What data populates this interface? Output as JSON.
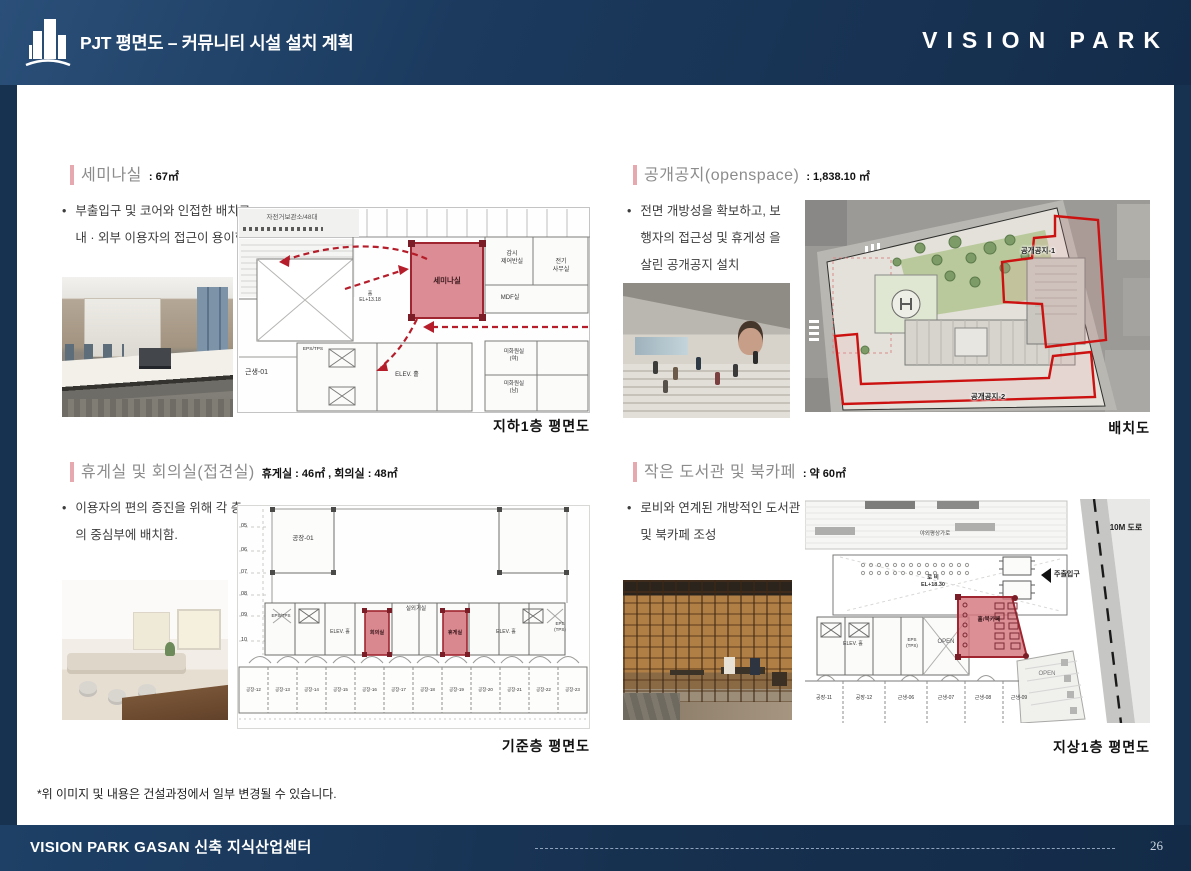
{
  "header": {
    "title": "PJT 평면도 – 커뮤니티 시설 설치 계획",
    "brand": "VISION PARK"
  },
  "sections": {
    "seminar": {
      "title": "세미나실",
      "area": ": 67㎡",
      "bullet": "부출입구 및 코어와 인접한 배치로 내 · 외부 이용자의 접근이 용이함.",
      "caption": "지하1층 평면도",
      "plan": {
        "bike_storage": "자전거보관소/48대",
        "highlight": "세미나실",
        "room_gamsi": "감시\n제어반실",
        "room_jeongi": "전기\n사무실",
        "room_mdf": "MDF실",
        "room_geunsaeng": "근생-01",
        "room_elev": "ELEV. 홀",
        "room_eps": "EPS/TPS",
        "hall_level": "홀\nEL+13.18",
        "room_mihwa_f": "미화원실\n(여)",
        "room_mihwa_m": "미화원실\n(남)"
      }
    },
    "openspace": {
      "title": "공개공지(openspace)",
      "area": ": 1,838.10 ㎡",
      "bullet": "전면 개방성을 확보하고, 보행자의 접근성 및 휴게성 을 살린 공개공지 설치",
      "caption": "배치도",
      "plan": {
        "zone1": "공개공지-1",
        "zone2": "공개공지-2"
      }
    },
    "lounge": {
      "title": "휴게실 및 회의실(접견실)",
      "area": "휴게실 : 46㎡ , 회의실 : 48㎡",
      "bullet": "이용자의 편의 증진을 위해 각 층의 중심부에 배치함.",
      "caption": "기준층 평면도",
      "plan": {
        "room_top": "공장-01",
        "room_eps": "EPS/TPS",
        "room_elev1": "ELEV. 홀",
        "highlight1": "회의실",
        "room_center": "실외기실",
        "highlight2": "휴게실",
        "room_elev2": "ELEV. 홀",
        "room_eps2": "EPS\n(TPS)",
        "row_numbers": [
          "05",
          "06",
          "07",
          "08",
          "09",
          "10"
        ],
        "bottom_rooms": [
          "공장-12",
          "공장-13",
          "공장-14",
          "공장-15",
          "공장-16",
          "공장-17",
          "공장-18",
          "공장-19",
          "공장-20",
          "공장-21",
          "공장-22",
          "공장-23"
        ]
      }
    },
    "library": {
      "title": "작은 도서관 및 북카페",
      "area": ": 약 60㎡",
      "bullet": "로비와 연계된 개방적인 도서관 및 북카페 조성",
      "caption": "지상1층 평면도",
      "plan": {
        "promenade": "야외평상가로",
        "lobby": "로 비\nEL+18.30",
        "entrance": "주출입구",
        "road": "10M 도로",
        "open1": "OPEN",
        "open2": "OPEN",
        "highlight": "홀/북카페",
        "room_elev": "ELEV. 홀",
        "room_eps": "EPS\n(TPS)",
        "bottom_rooms": [
          "공장-11",
          "공장-12",
          "근생-06",
          "근생-07",
          "근생-08",
          "근생-09"
        ]
      }
    }
  },
  "footnote": "*위 이미지 및 내용은 건설과정에서 일부 변경될 수 있습니다.",
  "footer": {
    "project": "VISION PARK GASAN 신축 지식산업센터",
    "page": "26"
  }
}
